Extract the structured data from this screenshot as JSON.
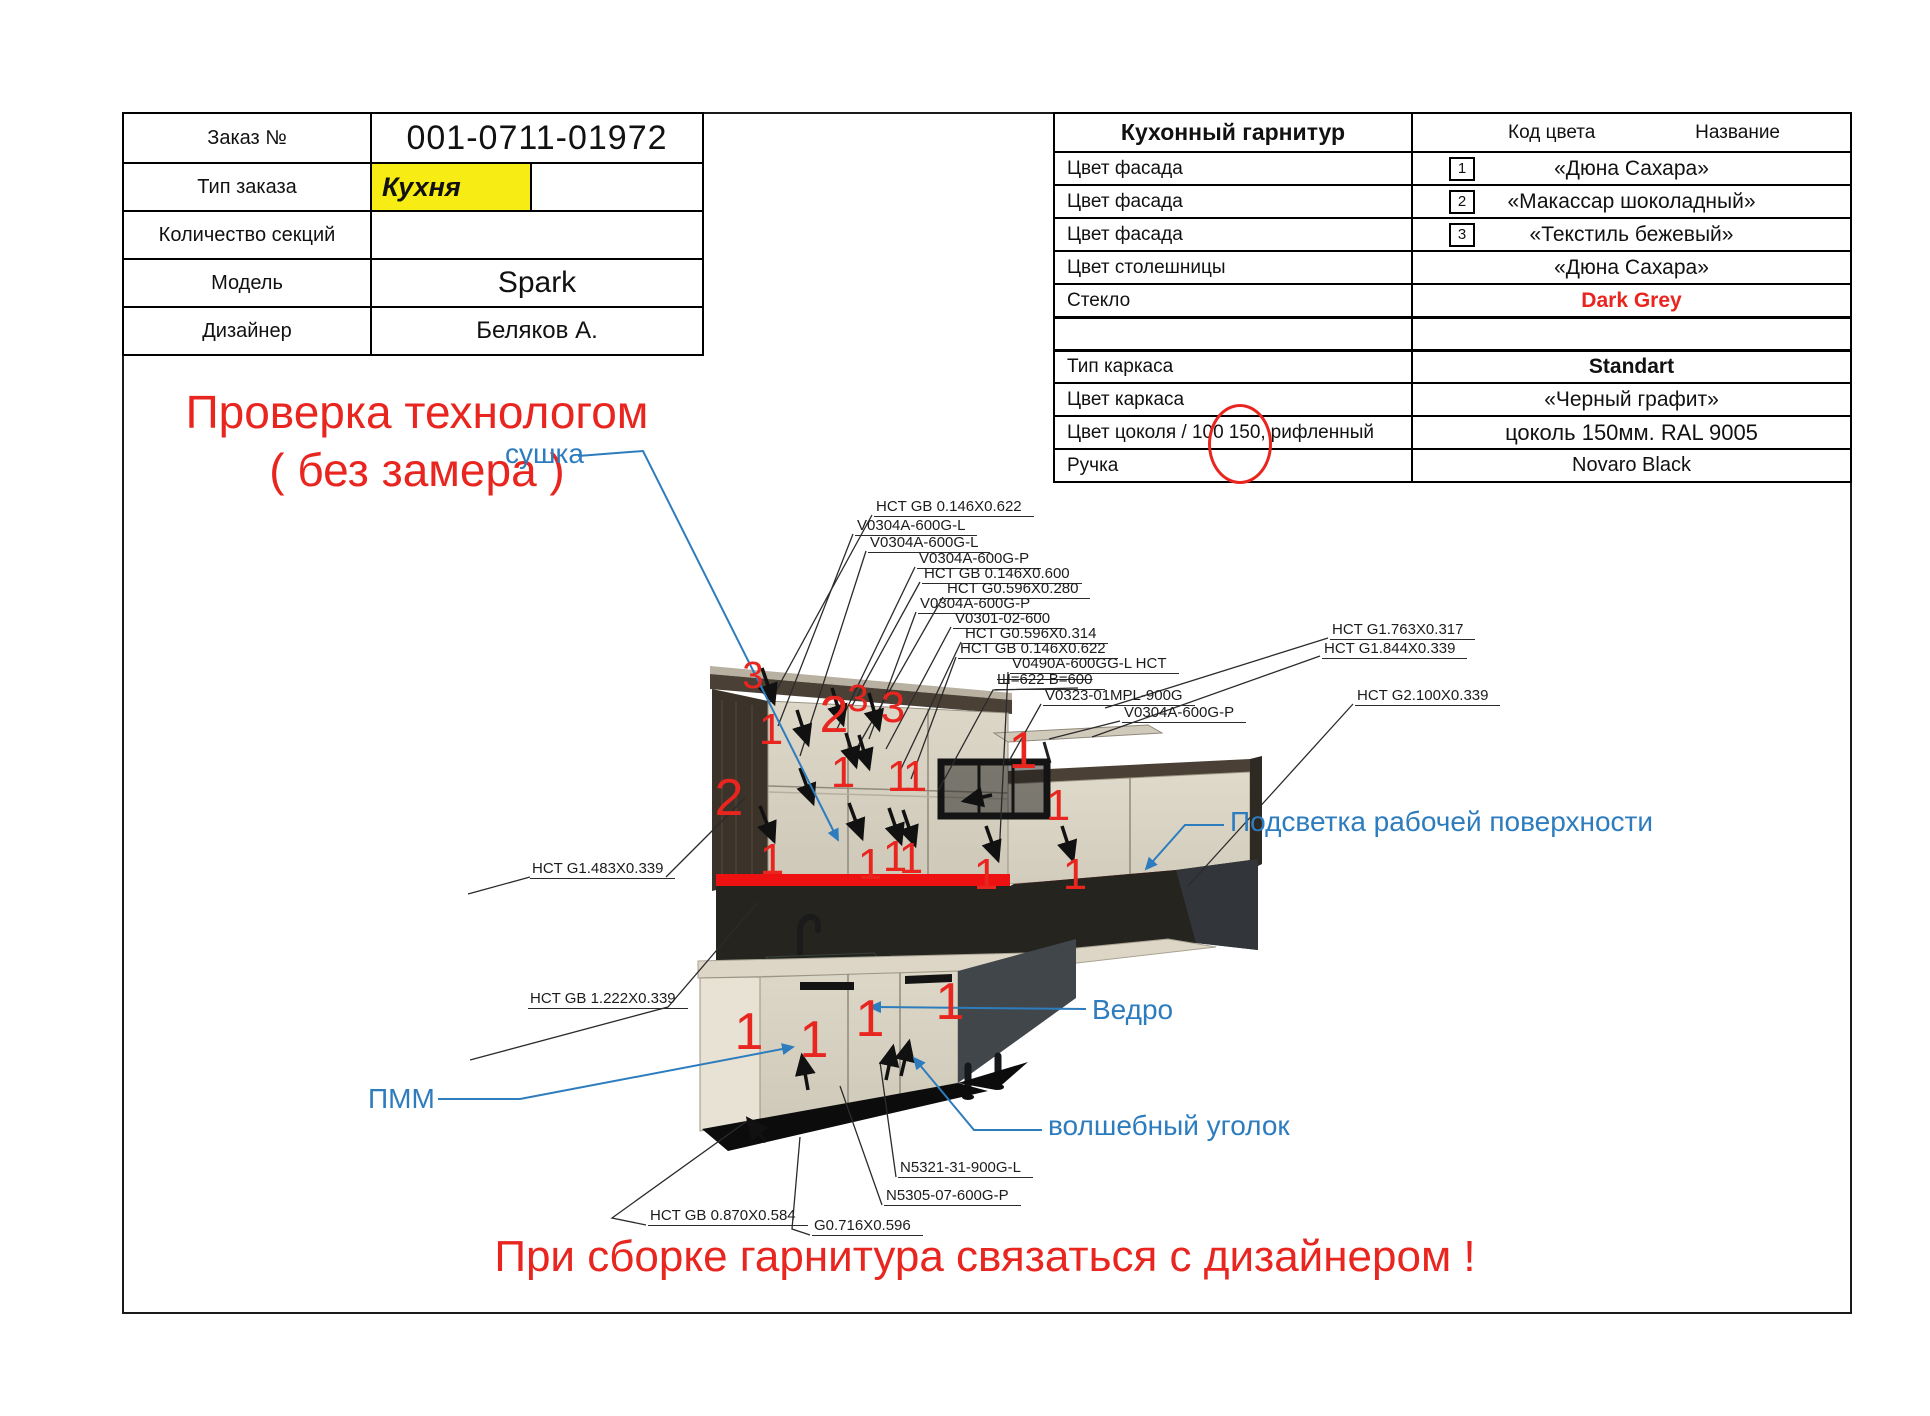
{
  "order": {
    "rows": [
      {
        "label": "Заказ №",
        "value": "001-0711-01972"
      },
      {
        "label": "Тип заказа",
        "value": "Кухня"
      },
      {
        "label": "Количество секций",
        "value": ""
      },
      {
        "label": "Модель",
        "value": "Spark"
      },
      {
        "label": "Дизайнер",
        "value": "Беляков А."
      }
    ]
  },
  "tech_check_line1": "Проверка технологом",
  "tech_check_line2": "( без замера )",
  "spec": {
    "title": "Кухонный гарнитур",
    "col_code": "Код цвета",
    "col_name": "Название",
    "rows": [
      {
        "label": "Цвет фасада",
        "code": "1",
        "value": "«Дюна Сахара»"
      },
      {
        "label": "Цвет фасада",
        "code": "2",
        "value": "«Макассар шоколадный»"
      },
      {
        "label": "Цвет фасада",
        "code": "3",
        "value": "«Текстиль бежевый»"
      },
      {
        "label": "Цвет столешницы",
        "code": "",
        "value": "«Дюна Сахара»"
      },
      {
        "label": "Стекло",
        "code": "",
        "value": "Dark Grey"
      },
      {
        "label": "",
        "code": "",
        "value": ""
      },
      {
        "label": "Тип каркаса",
        "code": "",
        "value": "Standart"
      },
      {
        "label": "Цвет каркаса",
        "code": "",
        "value": "«Черный графит»"
      },
      {
        "label_prefix": "Цвет цоколя / 100",
        "label_circled": "150,",
        "label_suffix": "рифленный",
        "code": "",
        "value": "цоколь 150мм. RAL 9005"
      },
      {
        "label": "Ручка",
        "code": "",
        "value": "Novaro Black"
      }
    ]
  },
  "bottom_note": "При сборке гарнитура связаться с дизайнером !",
  "colors": {
    "accent_red": "#e8251f",
    "annotation_blue": "#2d7cbe",
    "highlight_yellow": "#f7ec13",
    "led_red": "#ee1111"
  },
  "diagram": {
    "blue_notes": [
      {
        "id": "sushka",
        "text": "сушка",
        "x": 505,
        "y": 438,
        "pts": [
          [
            578,
            456
          ],
          [
            643,
            451
          ],
          [
            838,
            840
          ]
        ]
      },
      {
        "id": "podsvetka",
        "text": "Подсветка рабочей поверхности",
        "x": 1230,
        "y": 806,
        "pts": [
          [
            1224,
            825
          ],
          [
            1185,
            825
          ],
          [
            1146,
            869
          ]
        ]
      },
      {
        "id": "vedro",
        "text": "Ведро",
        "x": 1092,
        "y": 994,
        "pts": [
          [
            1086,
            1009
          ],
          [
            870,
            1007
          ]
        ]
      },
      {
        "id": "pmm",
        "text": "ПММ",
        "x": 368,
        "y": 1083,
        "pts": [
          [
            438,
            1099
          ],
          [
            520,
            1099
          ],
          [
            793,
            1047
          ]
        ]
      },
      {
        "id": "magic-corner",
        "text": "волшебный уголок",
        "x": 1048,
        "y": 1110,
        "pts": [
          [
            1042,
            1130
          ],
          [
            974,
            1130
          ],
          [
            914,
            1058
          ]
        ]
      }
    ],
    "part_labels": [
      {
        "text": "HCT GB 0.146X0.622",
        "x": 874,
        "y": 498,
        "lines": [
          [
            [
              872,
              515
            ],
            [
              770,
              702
            ]
          ]
        ]
      },
      {
        "text": "V0304A-600G-L",
        "x": 855,
        "y": 517,
        "lines": [
          [
            [
              853,
              534
            ],
            [
              778,
              726
            ]
          ]
        ]
      },
      {
        "text": "V0304A-600G-L",
        "x": 868,
        "y": 534,
        "lines": [
          [
            [
              866,
              551
            ],
            [
              800,
              756
            ]
          ]
        ]
      },
      {
        "text": "V0304A-600G-P",
        "x": 917,
        "y": 550,
        "lines": [
          [
            [
              915,
              567
            ],
            [
              836,
              731
            ]
          ]
        ]
      },
      {
        "text": "HCT GB 0.146X0.600",
        "x": 922,
        "y": 565,
        "lines": [
          [
            [
              920,
              582
            ],
            [
              852,
              706
            ]
          ]
        ]
      },
      {
        "text": "HCT G0.596X0.280",
        "x": 945,
        "y": 580,
        "lines": [
          [
            [
              943,
              597
            ],
            [
              858,
              746
            ]
          ]
        ]
      },
      {
        "text": "V0304A-600G-P",
        "x": 918,
        "y": 595,
        "lines": [
          [
            [
              916,
              612
            ],
            [
              869,
              739
            ]
          ]
        ]
      },
      {
        "text": "V0301-02-600",
        "x": 953,
        "y": 610,
        "lines": [
          [
            [
              951,
              627
            ],
            [
              886,
              749
            ]
          ]
        ]
      },
      {
        "text": "HCT G0.596X0.314",
        "x": 963,
        "y": 625,
        "lines": [
          [
            [
              961,
              642
            ],
            [
              899,
              773
            ]
          ]
        ]
      },
      {
        "text": "HCT GB 0.146X0.622",
        "x": 958,
        "y": 640,
        "lines": [
          [
            [
              956,
              657
            ],
            [
              911,
              779
            ]
          ]
        ]
      },
      {
        "text": "V0490A-600GG-L HCT",
        "x": 1010,
        "y": 655,
        "lines": [
          [
            [
              1008,
              672
            ],
            [
              999,
              858
            ]
          ]
        ]
      },
      {
        "text": "Ш=622 В=600",
        "x": 995,
        "y": 671,
        "struck": true,
        "lines": [
          [
            [
              1078,
              688
            ],
            [
              993,
              690
            ],
            [
              938,
              791
            ]
          ]
        ]
      },
      {
        "text": "V0323-01MPL-900G",
        "x": 1043,
        "y": 687,
        "lines": [
          [
            [
              1041,
              704
            ],
            [
              1009,
              761
            ]
          ]
        ]
      },
      {
        "text": "V0304A-600G-P",
        "x": 1122,
        "y": 704,
        "lines": [
          [
            [
              1120,
              721
            ],
            [
              1049,
              739
            ]
          ]
        ]
      },
      {
        "text": "HCT G1.763X0.317",
        "x": 1330,
        "y": 621,
        "lines": [
          [
            [
              1328,
              638
            ],
            [
              1105,
              708
            ]
          ]
        ]
      },
      {
        "text": "HCT G1.844X0.339",
        "x": 1322,
        "y": 640,
        "lines": [
          [
            [
              1320,
              656
            ],
            [
              1092,
              737
            ]
          ]
        ]
      },
      {
        "text": "HCT G2.100X0.339",
        "x": 1355,
        "y": 687,
        "lines": [
          [
            [
              1353,
              704
            ],
            [
              1188,
              886
            ]
          ]
        ]
      },
      {
        "text": "HCT G1.483X0.339",
        "x": 530,
        "y": 860,
        "lines": [
          [
            [
              468,
              894
            ],
            [
              530,
              877
            ]
          ],
          [
            [
              666,
              877
            ],
            [
              745,
              798
            ]
          ]
        ]
      },
      {
        "text": "HCT GB 1.222X0.339",
        "x": 528,
        "y": 990,
        "lines": [
          [
            [
              470,
              1060
            ],
            [
              668,
              1007
            ],
            [
              758,
              902
            ]
          ]
        ]
      },
      {
        "text": "N5321-31-900G-L",
        "x": 898,
        "y": 1159,
        "lines": [
          [
            [
              896,
              1177
            ],
            [
              880,
              1062
            ]
          ]
        ]
      },
      {
        "text": "N5305-07-600G-P",
        "x": 884,
        "y": 1187,
        "lines": [
          [
            [
              882,
              1205
            ],
            [
              840,
              1086
            ]
          ]
        ]
      },
      {
        "text": "HCT GB 0.870X0.584",
        "x": 648,
        "y": 1207,
        "lines": [
          [
            [
              646,
              1225
            ],
            [
              612,
              1218
            ],
            [
              747,
              1121
            ]
          ]
        ]
      },
      {
        "text": "G0.716X0.596",
        "x": 812,
        "y": 1217,
        "lines": [
          [
            [
              810,
              1235
            ],
            [
              792,
              1229
            ],
            [
              800,
              1137
            ]
          ]
        ]
      }
    ],
    "red_numbers": [
      {
        "t": "3",
        "x": 753,
        "y": 677,
        "s": 38
      },
      {
        "t": "1",
        "x": 771,
        "y": 731,
        "s": 44
      },
      {
        "t": "2",
        "x": 834,
        "y": 716,
        "s": 52
      },
      {
        "t": "3",
        "x": 858,
        "y": 700,
        "s": 38
      },
      {
        "t": "3",
        "x": 893,
        "y": 709,
        "s": 44
      },
      {
        "t": "1",
        "x": 843,
        "y": 774,
        "s": 44
      },
      {
        "t": "1",
        "x": 899,
        "y": 778,
        "s": 44
      },
      {
        "t": "1",
        "x": 915,
        "y": 778,
        "s": 44
      },
      {
        "t": "2",
        "x": 729,
        "y": 799,
        "s": 52
      },
      {
        "t": "1",
        "x": 772,
        "y": 861,
        "s": 44
      },
      {
        "t": "1",
        "x": 870,
        "y": 866,
        "s": 44
      },
      {
        "t": "1",
        "x": 895,
        "y": 858,
        "s": 44
      },
      {
        "t": "1",
        "x": 911,
        "y": 860,
        "s": 44
      },
      {
        "t": "1",
        "x": 986,
        "y": 876,
        "s": 44
      },
      {
        "t": "1",
        "x": 1075,
        "y": 876,
        "s": 44
      },
      {
        "t": "1",
        "x": 1023,
        "y": 752,
        "s": 52
      },
      {
        "t": "1",
        "x": 1058,
        "y": 807,
        "s": 44
      },
      {
        "t": "1",
        "x": 749,
        "y": 1033,
        "s": 52
      },
      {
        "t": "1",
        "x": 814,
        "y": 1041,
        "s": 52
      },
      {
        "t": "1",
        "x": 870,
        "y": 1020,
        "s": 52
      },
      {
        "t": "1",
        "x": 950,
        "y": 1003,
        "s": 52
      }
    ],
    "door_arrows": [
      [
        762,
        668,
        774,
        703
      ],
      [
        797,
        710,
        808,
        744
      ],
      [
        832,
        688,
        843,
        724
      ],
      [
        869,
        693,
        879,
        729
      ],
      [
        846,
        733,
        856,
        766
      ],
      [
        859,
        735,
        869,
        768
      ],
      [
        800,
        768,
        813,
        803
      ],
      [
        760,
        806,
        774,
        841
      ],
      [
        849,
        803,
        862,
        838
      ],
      [
        889,
        808,
        901,
        843
      ],
      [
        903,
        810,
        915,
        845
      ],
      [
        986,
        826,
        998,
        860
      ],
      [
        1062,
        826,
        1073,
        860
      ],
      [
        992,
        795,
        964,
        801
      ],
      [
        808,
        1090,
        802,
        1056
      ],
      [
        886,
        1080,
        893,
        1047
      ],
      [
        901,
        1076,
        909,
        1042
      ],
      [
        766,
        1142,
        748,
        1119
      ]
    ]
  }
}
